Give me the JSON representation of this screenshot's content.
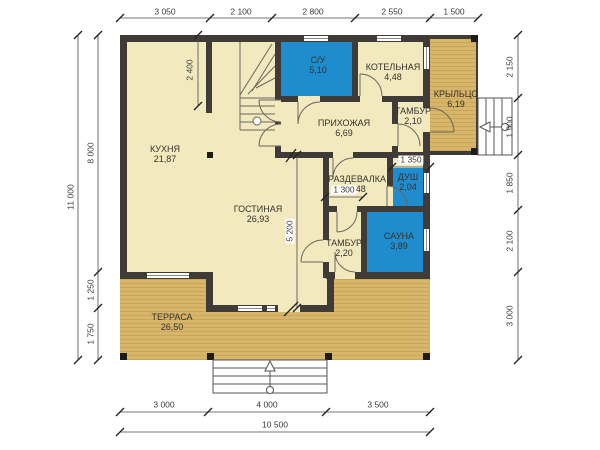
{
  "plan": {
    "type": "floor-plan",
    "colors": {
      "floor": "#F3E9BF",
      "deck_wood": "#D7B66B",
      "wet_room": "#1E8CCD",
      "wall": "#3F3C38"
    },
    "rooms": [
      {
        "name": "КУХНЯ",
        "area": "21,87"
      },
      {
        "name": "ГОСТИНАЯ",
        "area": "26,93"
      },
      {
        "name": "С/У",
        "area": "5,10"
      },
      {
        "name": "КОТЕЛЬНАЯ",
        "area": "4,48"
      },
      {
        "name": "КРЫЛЬЦО",
        "area": "6,19"
      },
      {
        "name": "ТАМБУР",
        "area": "2,10"
      },
      {
        "name": "ПРИХОЖАЯ",
        "area": "6,69"
      },
      {
        "name": "РАЗДЕВАЛКА",
        "area": "3,48"
      },
      {
        "name": "ДУШ",
        "area": "2,04"
      },
      {
        "name": "ТАМБУР",
        "area": "2,20"
      },
      {
        "name": "САУНА",
        "area": "3,89"
      },
      {
        "name": "ТЕРРАСА",
        "area": "26,50"
      }
    ],
    "dimensions": {
      "top": [
        "3 050",
        "2 100",
        "2 800",
        "2 550",
        "1 500"
      ],
      "left": [
        "8 000",
        "1 250",
        "1 750"
      ],
      "left_total": "11 000",
      "right": [
        "2 150",
        "1 900",
        "1 850",
        "2 100",
        "3 000"
      ],
      "bottom": [
        "3 000",
        "4 000",
        "3 500"
      ],
      "bottom_total": "10 500",
      "interior": [
        "2 400",
        "5 200",
        "1 300",
        "1 350"
      ]
    }
  }
}
